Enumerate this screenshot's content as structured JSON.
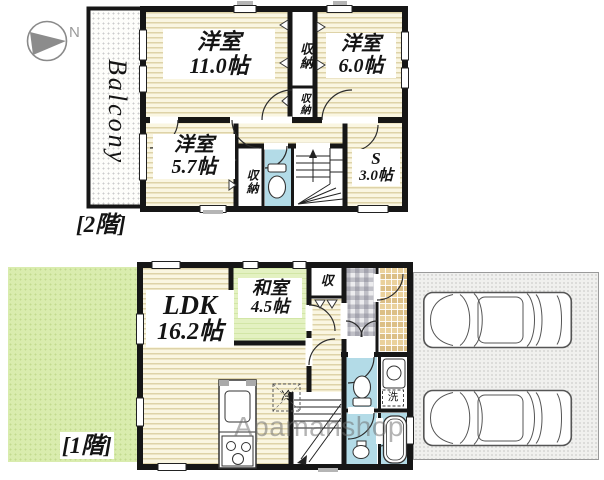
{
  "compass": {
    "north": "N"
  },
  "watermark": {
    "text": "Apamanshop"
  },
  "floor2": {
    "label": "[2階]",
    "balcony": "Balcony",
    "rooms": {
      "r11": {
        "name": "洋室",
        "size": "11.0帖"
      },
      "r6": {
        "name": "洋室",
        "size": "6.0帖"
      },
      "r57": {
        "name": "洋室",
        "size": "5.7帖"
      },
      "s": {
        "name": "S",
        "size": "3.0帖"
      },
      "closet_tall": {
        "label": "収納"
      },
      "closet_small": {
        "label": "収納"
      },
      "closet_57": {
        "label": "収納"
      }
    }
  },
  "floor1": {
    "label": "[1階]",
    "rooms": {
      "ldk": {
        "name": "LDK",
        "size": "16.2帖"
      },
      "washitsu": {
        "name": "和室",
        "size": "4.5帖"
      },
      "closet": {
        "label": "収"
      },
      "fridge": {
        "label": "冷"
      },
      "laundry": {
        "label": "洗"
      }
    }
  }
}
